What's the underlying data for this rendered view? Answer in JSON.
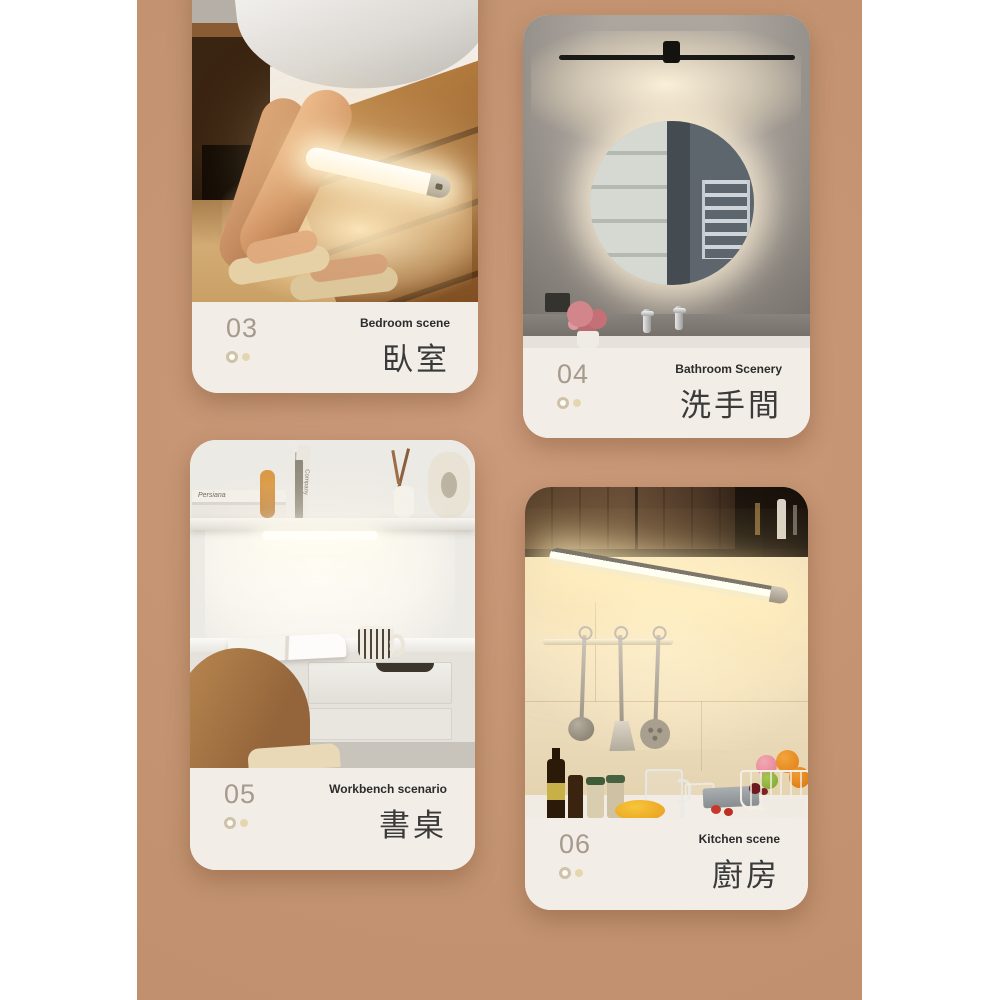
{
  "page": {
    "background": "#ffffff",
    "backdrop_color": "#c49472",
    "caption_bg": "#f2ede6",
    "number_color": "#a59a8c",
    "label_en_color": "#2c2c2c",
    "label_zh_color": "#3a3a3a",
    "dot_ring_color": "#cfc2a9",
    "dot_fill_color": "#e4d7b0"
  },
  "cards": [
    {
      "id": "bedroom",
      "number": "03",
      "label_en": "Bedroom scene",
      "label_zh": "臥室"
    },
    {
      "id": "bathroom",
      "number": "04",
      "label_en": "Bathroom Scenery",
      "label_zh": "洗手間"
    },
    {
      "id": "workbench",
      "number": "05",
      "label_en": "Workbench scenario",
      "label_zh": "書桌",
      "book_spines": [
        "Persiana",
        "Company"
      ]
    },
    {
      "id": "kitchen",
      "number": "06",
      "label_en": "Kitchen scene",
      "label_zh": "廚房"
    }
  ]
}
